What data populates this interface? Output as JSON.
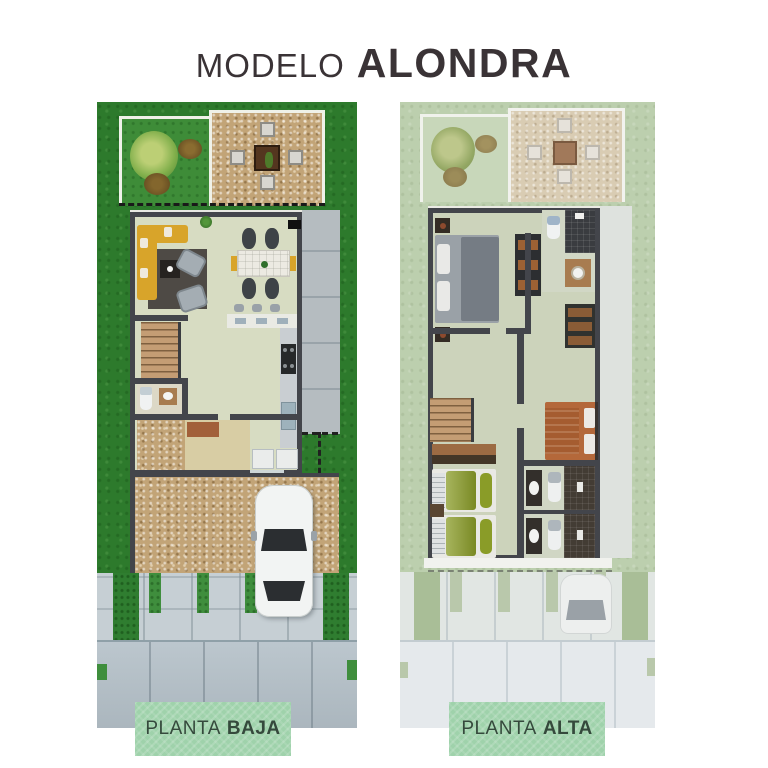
{
  "title": {
    "prefix": "MODELO",
    "name": "ALONDRA"
  },
  "labels": {
    "left": {
      "word": "PLANTA",
      "floor": "BAJA"
    },
    "right": {
      "word": "PLANTA",
      "floor": "ALTA"
    }
  },
  "colors": {
    "page_bg": "#ffffff",
    "title_text": "#3a3336",
    "label_bg": "#9fd2ab",
    "label_text": "#35493c",
    "grass": "#2d7a2c",
    "grass_faded": "#bccfae",
    "wall": "#43454b",
    "floor": "#d7dcc2",
    "floor_faded": "#ccd3bb",
    "deck": "#c2a477",
    "deck_faded": "#d9ccb3",
    "sofa": "#d8a42a",
    "street": "#b4c0c8",
    "street_faded": "#e5e9ec",
    "car": "#f2f4f3",
    "bed_master": "#9aa1a7",
    "bed_twin": "#8a9c28",
    "bed_secondary": "#b4683a"
  }
}
